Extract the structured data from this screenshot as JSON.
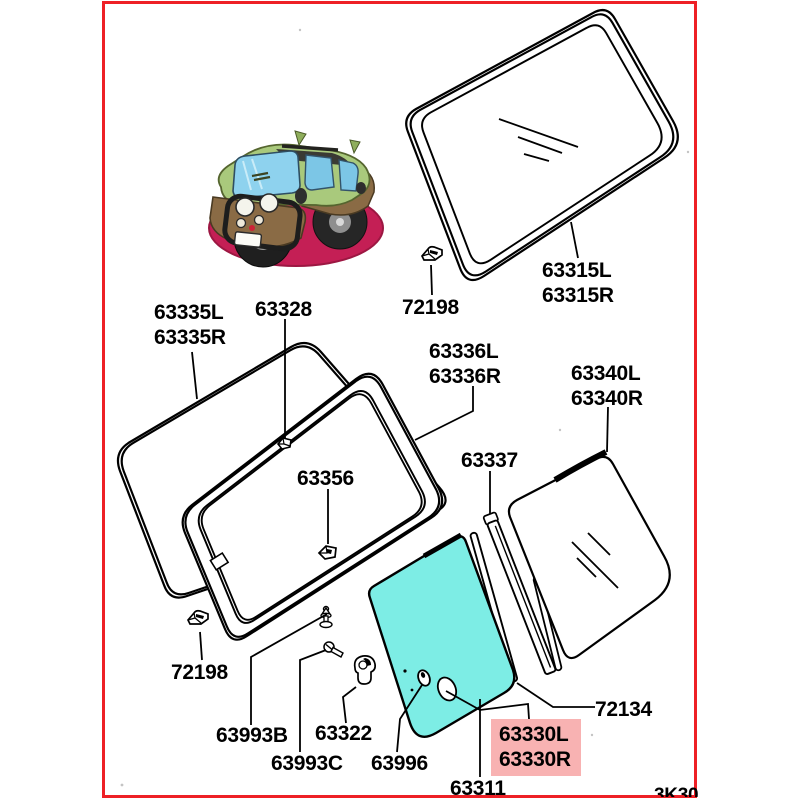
{
  "colors": {
    "border_red": "#ee2026",
    "glass_highlight_cyan": "#7dede5",
    "label_highlight_pink": "#f8b2b2",
    "pedestal_red": "#c41f55"
  },
  "stamp_code": "3K30",
  "parts": {
    "p63335": {
      "line1": "63335L",
      "line2": "63335R"
    },
    "p63328": {
      "label": "63328"
    },
    "p72198_top": {
      "label": "72198"
    },
    "p63315": {
      "line1": "63315L",
      "line2": "63315R"
    },
    "p63336": {
      "line1": "63336L",
      "line2": "63336R"
    },
    "p63340": {
      "line1": "63340L",
      "line2": "63340R"
    },
    "p63337": {
      "label": "63337"
    },
    "p63356": {
      "label": "63356"
    },
    "p72198_bottom": {
      "label": "72198"
    },
    "p63993b": {
      "label": "63993B"
    },
    "p63322": {
      "label": "63322"
    },
    "p63993c": {
      "label": "63993C"
    },
    "p63996": {
      "label": "63996"
    },
    "p63311": {
      "label": "63311"
    },
    "p63330": {
      "line1": "63330L",
      "line2": "63330R"
    },
    "p72134": {
      "label": "72134"
    }
  }
}
